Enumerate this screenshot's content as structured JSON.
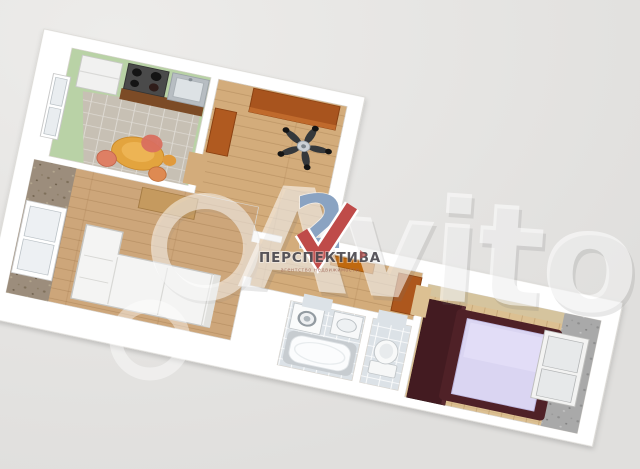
{
  "image": {
    "type": "3d-floor-plan-listing-photo",
    "background_color": "#e4e3e1",
    "sheet_color": "#ffffff",
    "plan_rotation_deg": 12
  },
  "watermarks": {
    "avito_main": "Avito",
    "avito_color": "rgba(255,255,255,0.55)",
    "agency_logo": {
      "digit_2": "2",
      "digit_1_shape": "red-checkmark-1",
      "name": "ПЕРСПЕКТИВА",
      "tagline": "агентство недвижимости",
      "digit2_color": "#8aa3c2",
      "check_color": "#bf4b49",
      "name_color": "#4b4950"
    }
  },
  "floor_plan": {
    "wall_color": "#ffffff",
    "rooms": [
      {
        "name": "kitchen",
        "floor_color": "#b9d2a6",
        "tile_color": "#c7c0b4",
        "features": [
          "fridge",
          "stove",
          "sink",
          "counter",
          "window",
          "dining-table",
          "chairs"
        ]
      },
      {
        "name": "hallway",
        "floor_color": "#d3ac7b",
        "features": [
          "wardrobe",
          "cabinet",
          "ceiling-fan"
        ]
      },
      {
        "name": "living-room",
        "floor_color": "#cda67a",
        "accent_wall_color": "#9c8d7c",
        "features": [
          "window",
          "corner-sofa",
          "sideboard"
        ]
      },
      {
        "name": "corridor",
        "floor_color": "#d3ac7b",
        "features": [
          "shoe-shelf",
          "cabinet"
        ]
      },
      {
        "name": "bathroom",
        "floor_color": "#dce2e7",
        "features": [
          "bathtub",
          "washing-machine",
          "sink"
        ]
      },
      {
        "name": "toilet",
        "floor_color": "#dce2e7",
        "features": [
          "toilet"
        ]
      },
      {
        "name": "bedroom",
        "floor_color": "#dcc092",
        "accent_wall_color": "#a9a9a9",
        "features": [
          "double-bed",
          "dark-wardrobe",
          "white-wardrobe"
        ],
        "bed_frame_color": "#4f2127",
        "mattress_color": "#dad5f2"
      }
    ]
  }
}
